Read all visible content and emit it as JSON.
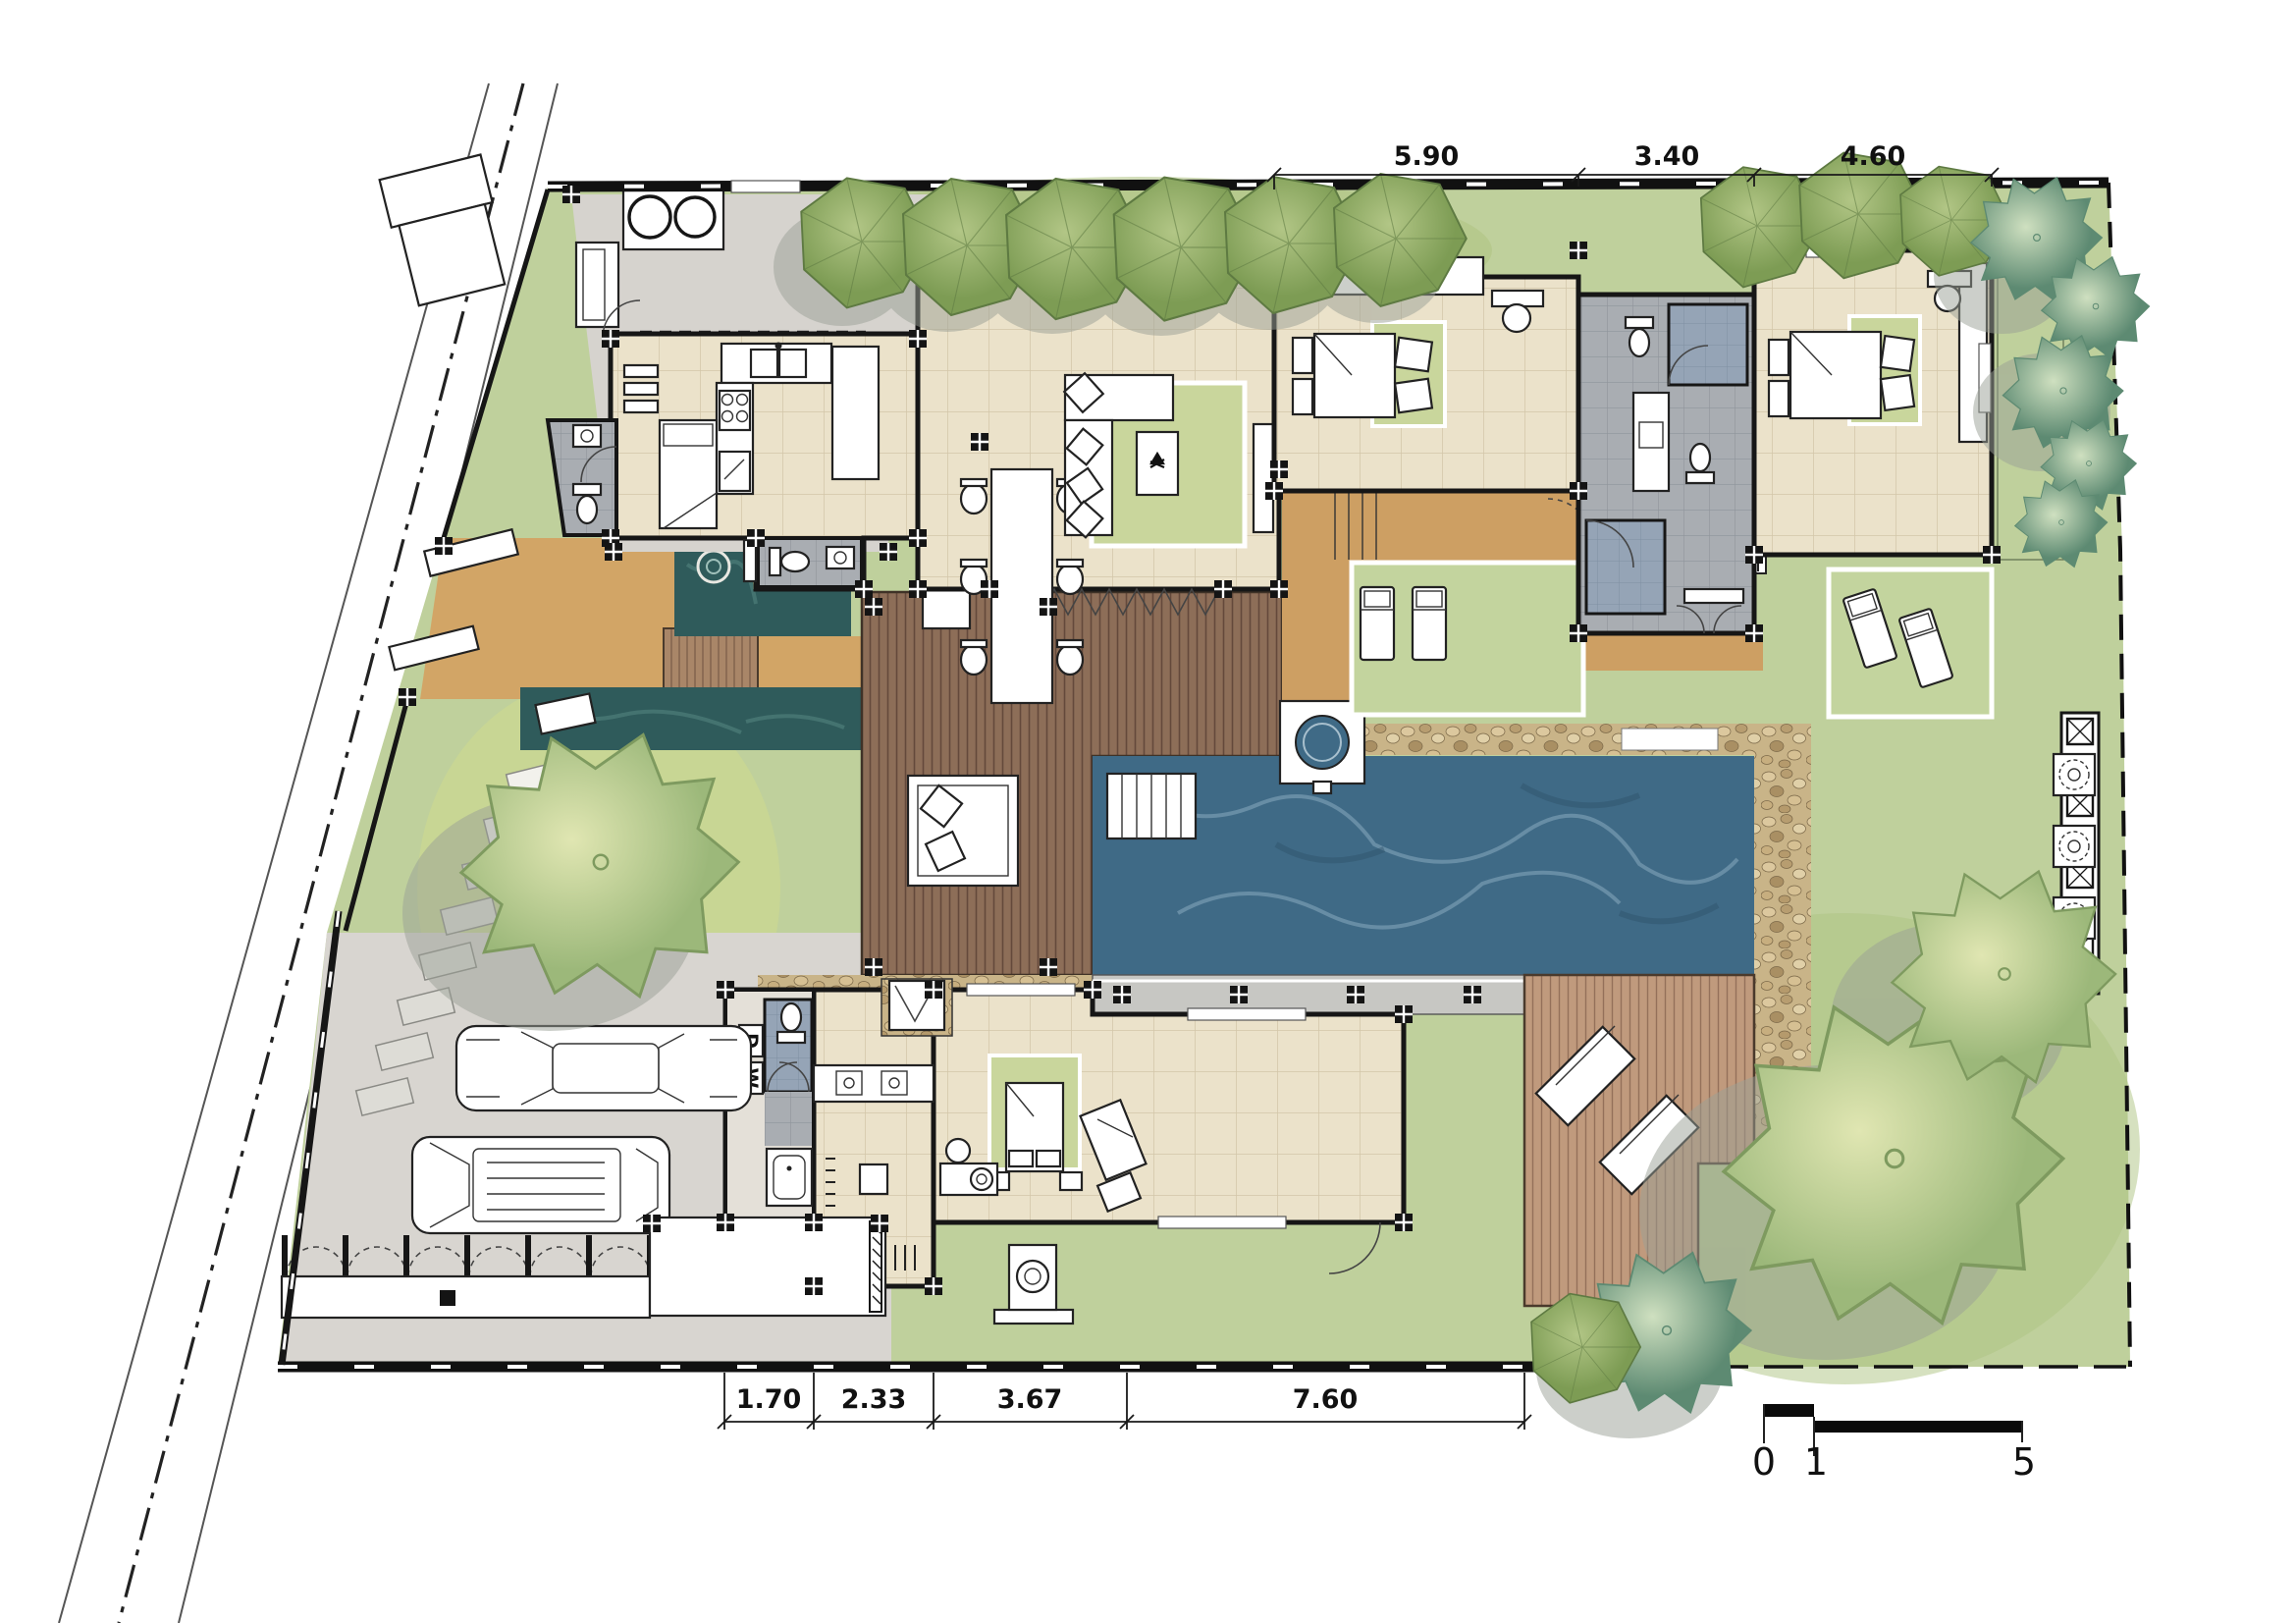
{
  "dimensions_top": {
    "items": [
      {
        "label": "5.90"
      },
      {
        "label": "3.40"
      },
      {
        "label": "4.60"
      }
    ]
  },
  "dimensions_bottom": {
    "items": [
      {
        "label": "1.70"
      },
      {
        "label": "2.33"
      },
      {
        "label": "3.67"
      },
      {
        "label": "7.60"
      }
    ]
  },
  "scale_bar": {
    "zero": "0",
    "one": "1",
    "five": "5"
  },
  "laundry": {
    "washer": "W",
    "dryer": "D"
  },
  "palette": {
    "lawn": "#bfd09c",
    "lawn_shade": "#aec381",
    "floor_tile": "#ebe2ca",
    "bath_tile": "#a9adb2",
    "shower_tile": "#95a4b6",
    "deck_dark": "#8d6e58",
    "deck_light": "#c09a7d",
    "bridge": "#a98668",
    "pool_water": "#3f6a86",
    "pond_water": "#2f5b5b",
    "entry_court": "#d2a566",
    "corridor": "#cd9f63",
    "driveway": "#d8d5d0",
    "service_floor": "#d6d3ce",
    "pebble": "#c9b488",
    "rug": "#c9d69c",
    "tree_green": "#96b063",
    "tree_pale": "#cdd9a4",
    "tree_teal": "#86ab92",
    "wall": "#161616"
  }
}
